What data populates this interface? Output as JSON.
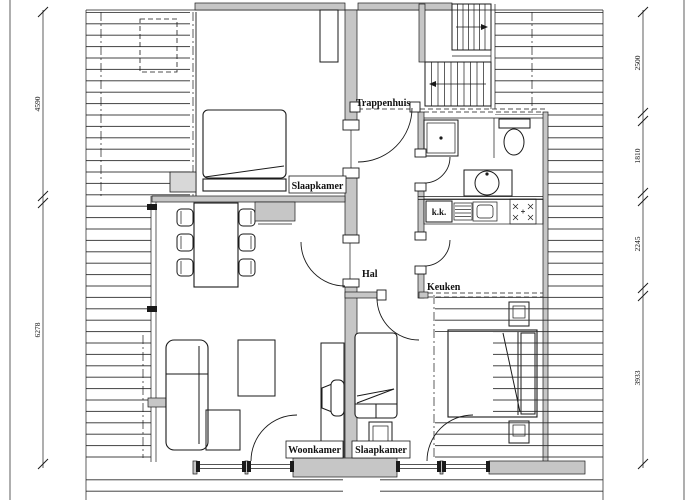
{
  "drawing": {
    "type": "floor-plan",
    "background": "#ffffff",
    "line_color": "#1a1a1a",
    "wall_fill": "#c6c6c6",
    "labels": {
      "trappenhuis": "Trappenhuis",
      "slaapkamer_top": "Slaapkamer",
      "hal": "Hal",
      "keuken": "Keuken",
      "woonkamer": "Woonkamer",
      "slaapkamer_bottom": "Slaapkamer",
      "koelkast": "k.k."
    },
    "dimensions_left": [
      {
        "value": "4590"
      },
      {
        "value": "6278"
      }
    ],
    "dimensions_right": [
      {
        "value": "2500"
      },
      {
        "value": "1810"
      },
      {
        "value": "2245"
      },
      {
        "value": "3933"
      }
    ]
  }
}
